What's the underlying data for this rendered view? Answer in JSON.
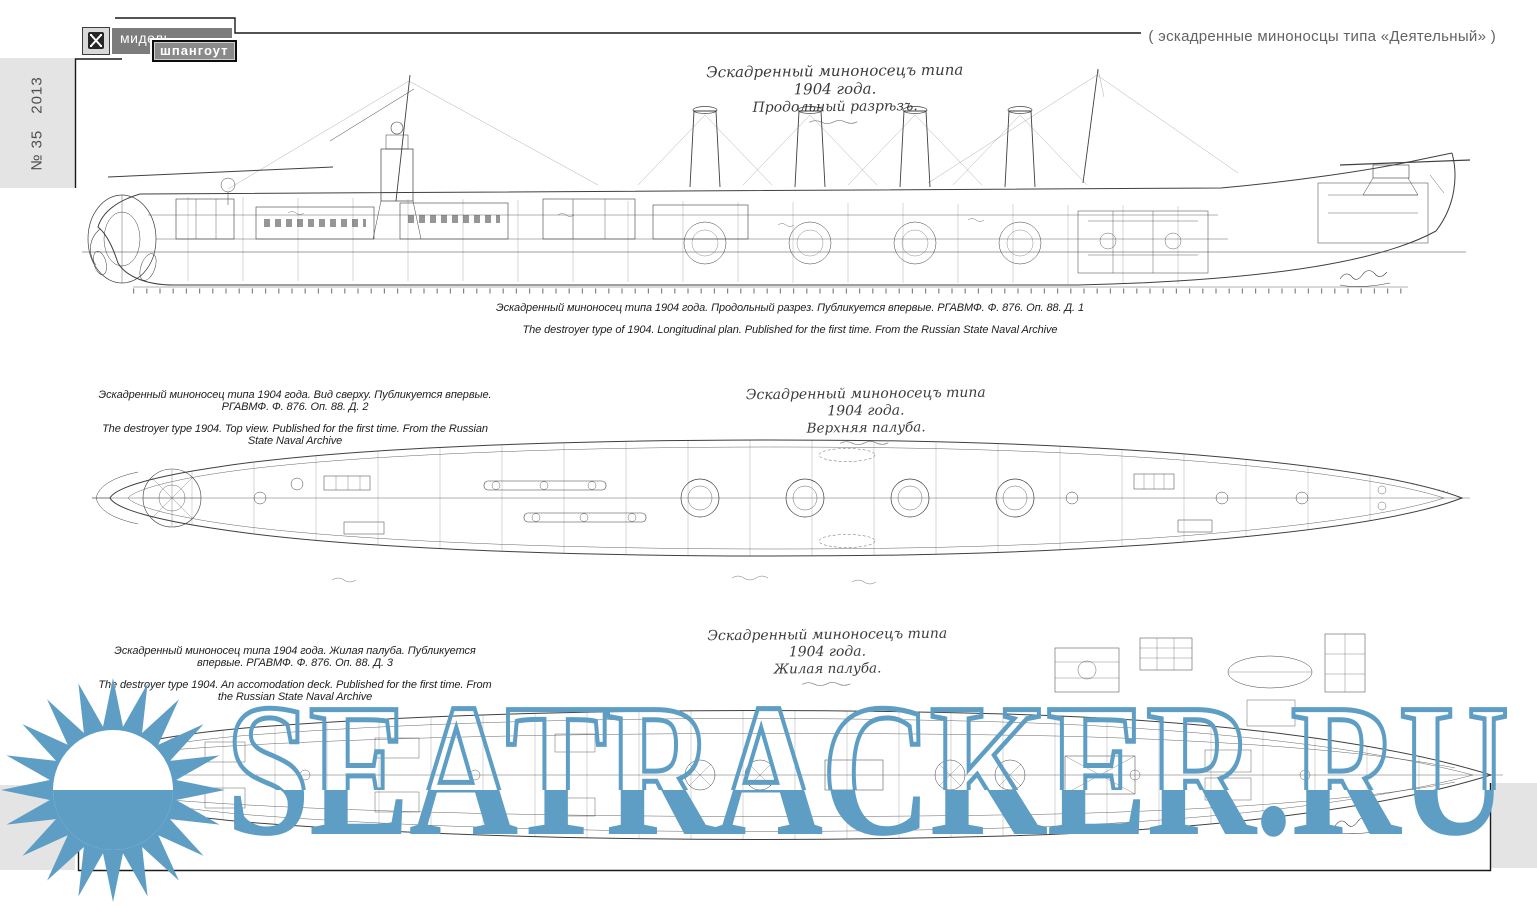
{
  "publication": {
    "logo_icon": "midship-section-icon",
    "logo_line1": "мидель-",
    "logo_line2": "шпангоут",
    "issue": "№ 35",
    "year": "2013"
  },
  "header": {
    "right_text": "( эскадренные миноносцы типа «Деятельный» )"
  },
  "drawings": [
    {
      "name": "longitudinal-section",
      "hand_title_line1": "Эскадренный миноносецъ типа 1904 года.",
      "hand_title_line2": "Продольный разрѣзъ.",
      "caption_ru": "Эскадренный миноносец типа 1904 года. Продольный разрез. Публикуется впервые. РГАВМФ. Ф. 876. Оп. 88. Д. 1",
      "caption_en": "The destroyer type of 1904. Longitudinal plan. Published for the first time. From the Russian State Naval Archive"
    },
    {
      "name": "top-view",
      "hand_title_line1": "Эскадренный миноносецъ типа 1904 года.",
      "hand_title_line2": "Верхняя палуба.",
      "caption_ru": "Эскадренный миноносец типа 1904 года. Вид сверху. Публикуется впервые. РГАВМФ. Ф. 876. Оп. 88. Д. 2",
      "caption_en": "The destroyer type 1904. Top view. Published for the first time. From the Russian State Naval Archive"
    },
    {
      "name": "accommodation-deck",
      "hand_title_line1": "Эскадренный миноносецъ типа 1904 года.",
      "hand_title_line2": "Жилая палуба.",
      "caption_ru": "Эскадренный миноносец типа 1904 года. Жилая палуба. Публикуется впервые. РГАВМФ. Ф. 876. Оп. 88. Д. 3",
      "caption_en": "The destroyer type 1904. An accomodation deck. Published for the first time. From the Russian State Naval Archive"
    }
  ],
  "watermark": {
    "text": "SEATRACKER.RU",
    "color": "#5E9EC4",
    "logo": "sun-logo"
  },
  "colors": {
    "sidebar_gray": "#e4e4e4",
    "logo_gray": "#7c7c7c",
    "frame_line": "#1a1a1a",
    "drawing_ink": "#3f3f3f"
  }
}
